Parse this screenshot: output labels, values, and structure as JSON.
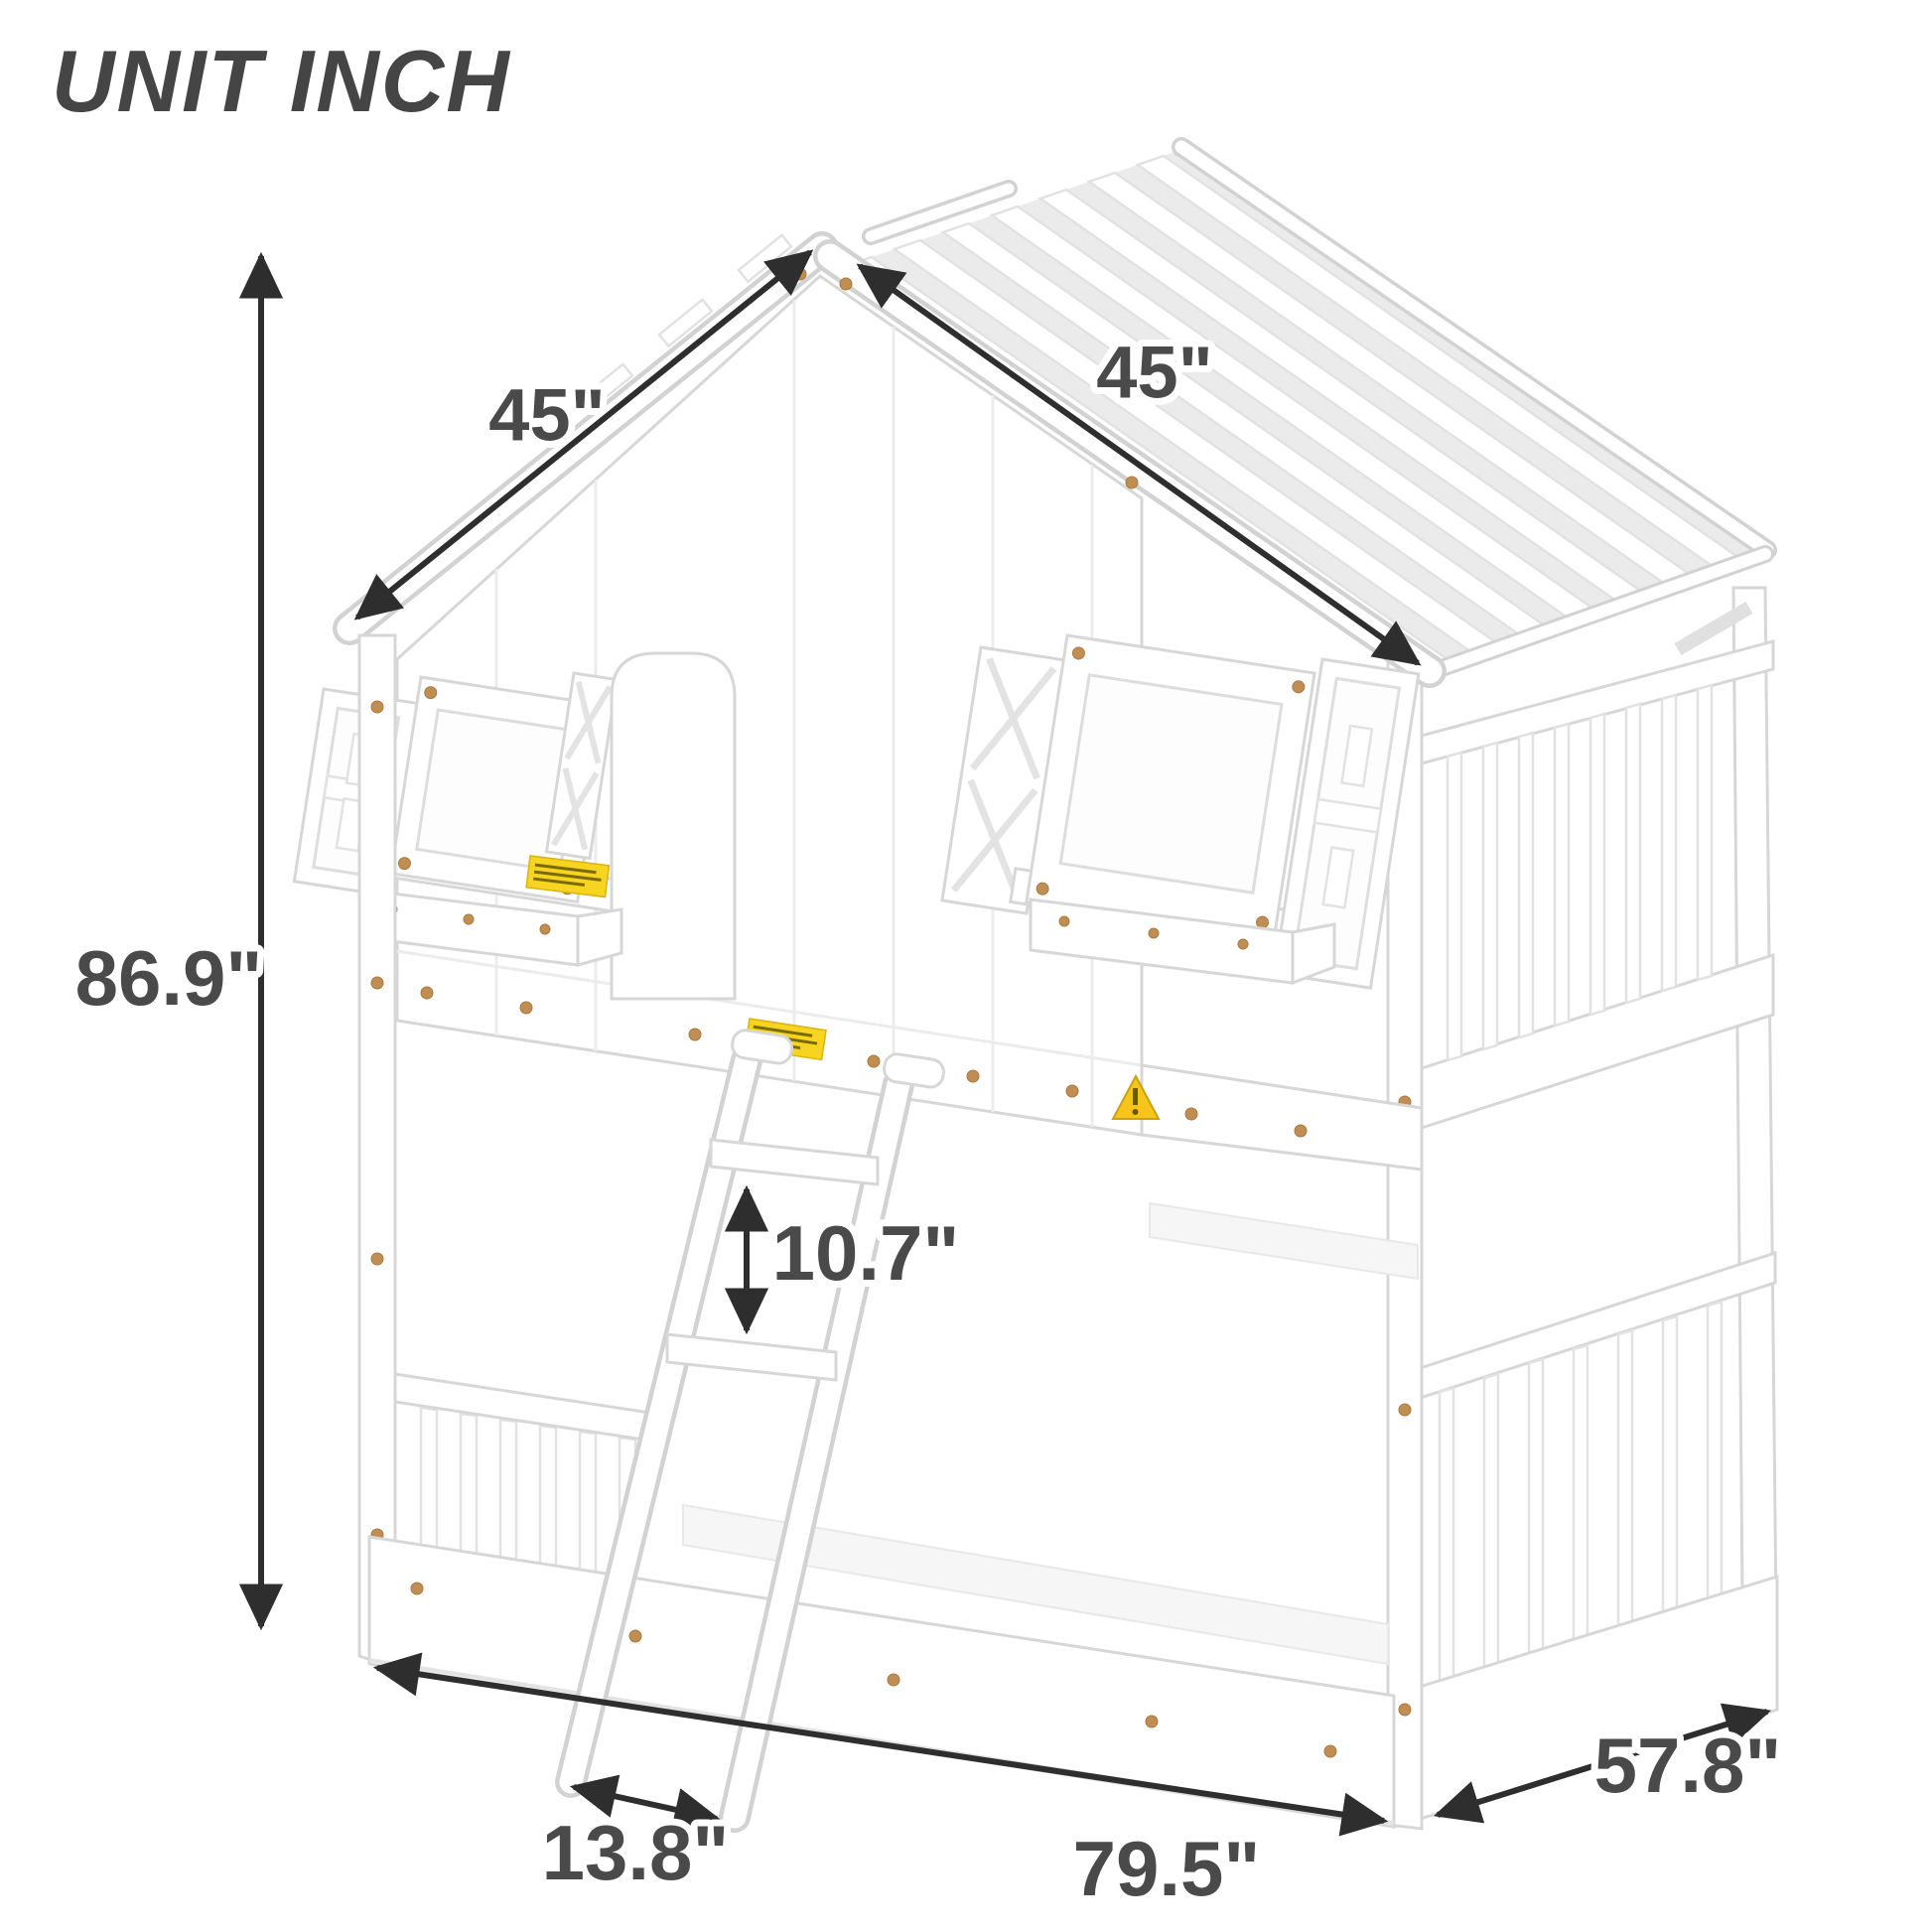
{
  "header": {
    "unit_label": "UNIT INCH"
  },
  "dimensions": {
    "roof_left": {
      "label": "45\""
    },
    "roof_right": {
      "label": "45\""
    },
    "height": {
      "label": "86.9\""
    },
    "rung_spacing": {
      "label": "10.7\""
    },
    "ladder_footprint": {
      "label": "13.8\""
    },
    "length": {
      "label": "79.5\""
    },
    "depth": {
      "label": "57.8\""
    }
  },
  "colors": {
    "dimension_arrow": "#2e2e2e",
    "dimension_text": "#4a4a4a",
    "bed_outline": "#d7d7d7",
    "roof_gap_shade": "#ebebeb",
    "warning_yellow": "#f6d41f",
    "screw_bronze": "#c08d52",
    "background": "#ffffff"
  },
  "illustration": {
    "subject": "house-shaped twin-over-twin bunk bed with roof slats, two shuttered windows, planter boxes and a slanted ladder"
  }
}
